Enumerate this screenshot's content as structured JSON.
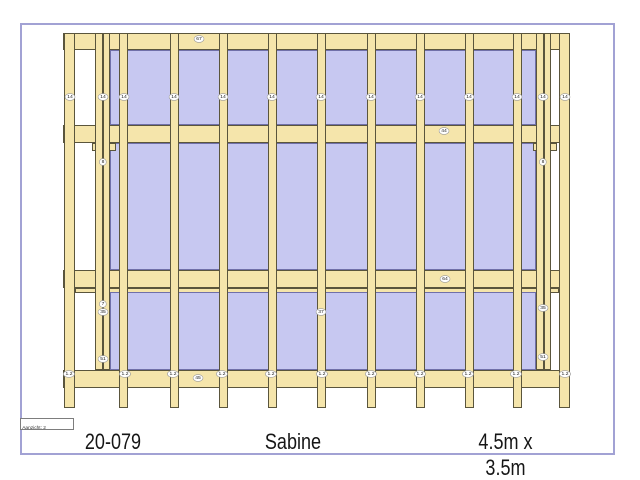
{
  "footer": {
    "project_number": "20-079",
    "name": "Sabine",
    "dimensions": "4.5m x 3.5m",
    "view_label": "Aanzicht:  2"
  },
  "colors": {
    "wood": "#f5e5ab",
    "wood_outline": "#5a553c",
    "panel": "#c7c8f1",
    "panel_outline": "#7070a9",
    "sheet_border": "#a2a2d4",
    "label_border": "#9a9a9a",
    "text": "#161616"
  },
  "drawing": {
    "plates": [
      {
        "x": 63,
        "y": 33,
        "w": 507,
        "h": 17
      },
      {
        "x": 63,
        "y": 125,
        "w": 507,
        "h": 18
      },
      {
        "x": 63,
        "y": 270,
        "w": 507,
        "h": 18
      },
      {
        "x": 75,
        "y": 288,
        "w": 484,
        "h": 5
      },
      {
        "x": 63,
        "y": 370,
        "w": 507,
        "h": 18
      }
    ],
    "panels": [
      {
        "x": 110,
        "y": 50,
        "w": 426,
        "h": 75
      },
      {
        "x": 110,
        "y": 143,
        "w": 426,
        "h": 127
      },
      {
        "x": 110,
        "y": 292,
        "w": 426,
        "h": 78
      }
    ],
    "tabs": [
      {
        "x": 92,
        "y": 143,
        "w": 24,
        "h": 8
      },
      {
        "x": 533,
        "y": 143,
        "w": 24,
        "h": 8
      }
    ],
    "studs": [
      {
        "x": 64,
        "w": 11,
        "y1": 33,
        "y2": 408
      },
      {
        "x": 95,
        "w": 8,
        "y1": 33,
        "y2": 370
      },
      {
        "x": 103,
        "w": 7,
        "y1": 33,
        "y2": 370
      },
      {
        "x": 119,
        "w": 9,
        "y1": 33,
        "y2": 408
      },
      {
        "x": 170,
        "w": 9,
        "y1": 33,
        "y2": 408
      },
      {
        "x": 219,
        "w": 9,
        "y1": 33,
        "y2": 408
      },
      {
        "x": 268,
        "w": 9,
        "y1": 33,
        "y2": 408
      },
      {
        "x": 317,
        "w": 9,
        "y1": 33,
        "y2": 408
      },
      {
        "x": 367,
        "w": 9,
        "y1": 33,
        "y2": 408
      },
      {
        "x": 416,
        "w": 9,
        "y1": 33,
        "y2": 408
      },
      {
        "x": 465,
        "w": 9,
        "y1": 33,
        "y2": 408
      },
      {
        "x": 513,
        "w": 9,
        "y1": 33,
        "y2": 408
      },
      {
        "x": 536,
        "w": 8,
        "y1": 33,
        "y2": 370
      },
      {
        "x": 544,
        "w": 7,
        "y1": 33,
        "y2": 370
      },
      {
        "x": 559,
        "w": 11,
        "y1": 33,
        "y2": 408
      }
    ],
    "labels": [
      {
        "text": "67",
        "x": 199,
        "y": 39
      },
      {
        "text": "14",
        "x": 70,
        "y": 97
      },
      {
        "text": "14",
        "x": 103,
        "y": 97
      },
      {
        "text": "14",
        "x": 124,
        "y": 97
      },
      {
        "text": "14",
        "x": 174,
        "y": 97
      },
      {
        "text": "14",
        "x": 223,
        "y": 97
      },
      {
        "text": "14",
        "x": 272,
        "y": 97
      },
      {
        "text": "14",
        "x": 321,
        "y": 97
      },
      {
        "text": "14",
        "x": 371,
        "y": 97
      },
      {
        "text": "14",
        "x": 420,
        "y": 97
      },
      {
        "text": "14",
        "x": 469,
        "y": 97
      },
      {
        "text": "14",
        "x": 517,
        "y": 97
      },
      {
        "text": "14",
        "x": 543,
        "y": 97
      },
      {
        "text": "14",
        "x": 565,
        "y": 97
      },
      {
        "text": "44",
        "x": 444,
        "y": 131
      },
      {
        "text": "8",
        "x": 103,
        "y": 162
      },
      {
        "text": "8",
        "x": 543,
        "y": 162
      },
      {
        "text": "64",
        "x": 445,
        "y": 279
      },
      {
        "text": "7",
        "x": 103,
        "y": 304
      },
      {
        "text": "35",
        "x": 103,
        "y": 312
      },
      {
        "text": "35",
        "x": 543,
        "y": 308
      },
      {
        "text": "37",
        "x": 321,
        "y": 312
      },
      {
        "text": "51",
        "x": 103,
        "y": 359
      },
      {
        "text": "51",
        "x": 543,
        "y": 357
      },
      {
        "text": "1.2",
        "x": 69,
        "y": 374
      },
      {
        "text": "1.2",
        "x": 125,
        "y": 374
      },
      {
        "text": "1.2",
        "x": 173,
        "y": 374
      },
      {
        "text": "1.2",
        "x": 222,
        "y": 374
      },
      {
        "text": "1.2",
        "x": 271,
        "y": 374
      },
      {
        "text": "1.2",
        "x": 322,
        "y": 374
      },
      {
        "text": "1.2",
        "x": 371,
        "y": 374
      },
      {
        "text": "1.2",
        "x": 420,
        "y": 374
      },
      {
        "text": "1.2",
        "x": 468,
        "y": 374
      },
      {
        "text": "1.2",
        "x": 516,
        "y": 374
      },
      {
        "text": "1.2",
        "x": 565,
        "y": 374
      },
      {
        "text": "45",
        "x": 198,
        "y": 378
      }
    ]
  }
}
